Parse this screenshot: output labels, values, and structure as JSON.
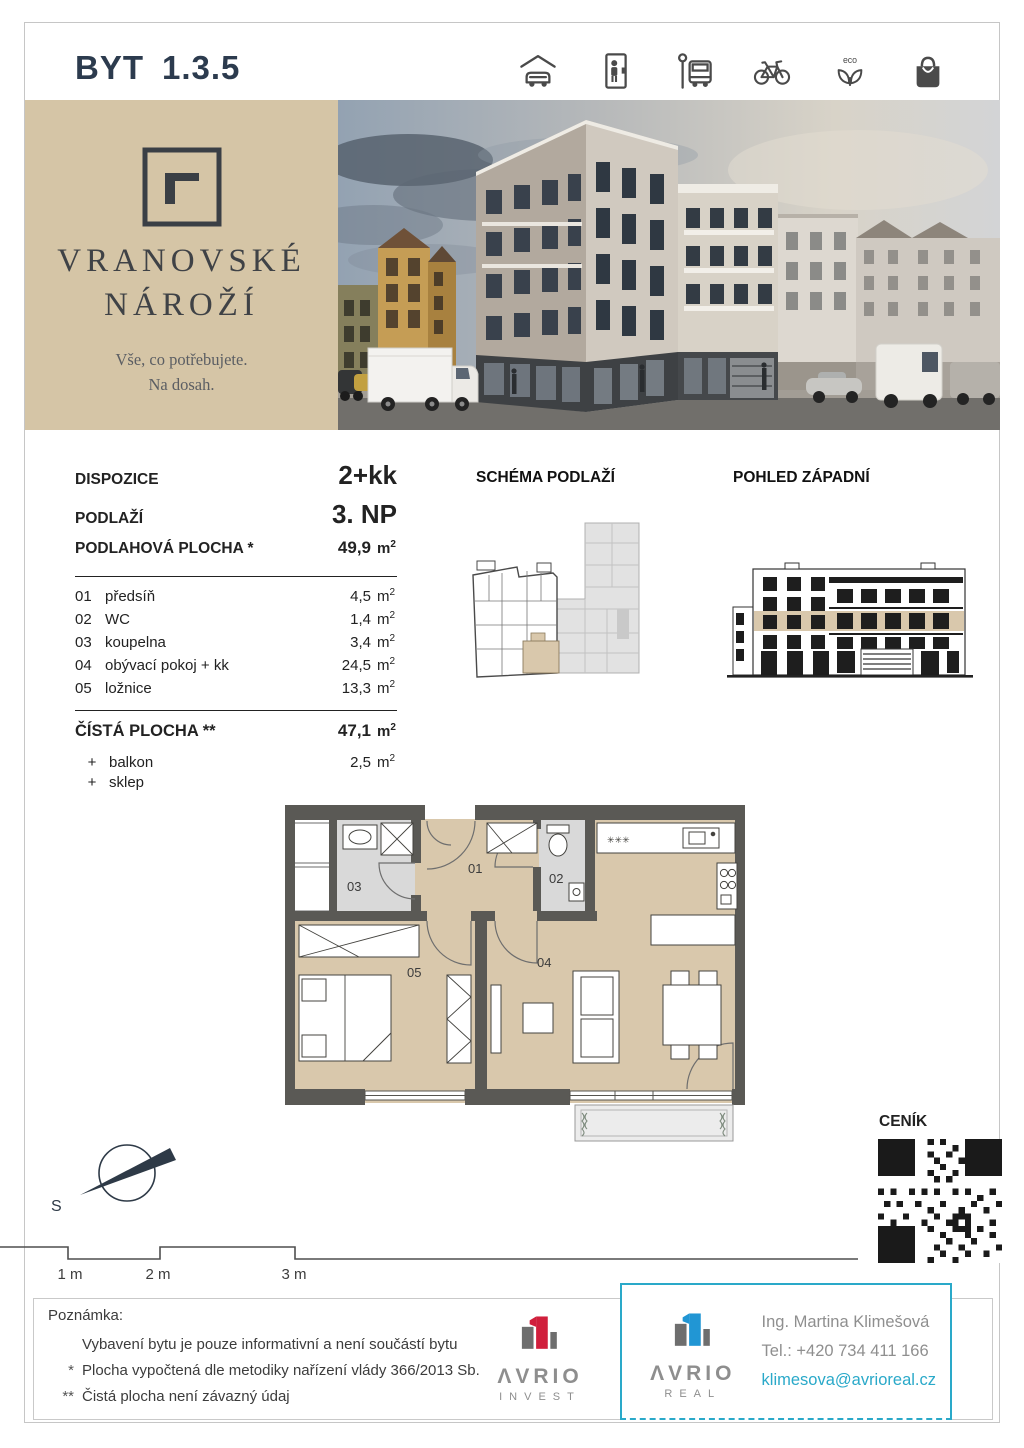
{
  "header": {
    "title_prefix": "BYT",
    "title_number": "1.3.5"
  },
  "amenities": {
    "eco_label": "eco"
  },
  "brand": {
    "line1": "VRANOVSKÉ",
    "line2": "NÁROŽÍ",
    "tagline1": "Vše, co potřebujete.",
    "tagline2": "Na dosah."
  },
  "specs": {
    "rows_main": [
      {
        "label": "DISPOZICE",
        "value": "2+kk"
      },
      {
        "label": "PODLAŽÍ",
        "value": "3. NP"
      }
    ],
    "area_label": "PODLAHOVÁ PLOCHA *",
    "area_value": "49,9",
    "unit_m": "m",
    "unit_sup": "2",
    "rooms": [
      {
        "num": "01",
        "name": "předsíň",
        "area": "4,5"
      },
      {
        "num": "02",
        "name": "WC",
        "area": "1,4"
      },
      {
        "num": "03",
        "name": "koupelna",
        "area": "3,4"
      },
      {
        "num": "04",
        "name": "obývací pokoj + kk",
        "area": "24,5"
      },
      {
        "num": "05",
        "name": "ložnice",
        "area": "13,3"
      }
    ],
    "net_label": "ČÍSTÁ PLOCHA **",
    "net_value": "47,1",
    "extras": [
      {
        "sign": "+",
        "name": "balkon",
        "area": "2,5"
      },
      {
        "sign": "+",
        "name": "sklep",
        "area": ""
      }
    ]
  },
  "sections": {
    "schema": "SCHÉMA PODLAŽÍ",
    "elevation": "POHLED ZÁPADNÍ",
    "price": "CENÍK"
  },
  "floorplan": {
    "r1": "01",
    "r2": "02",
    "r3": "03",
    "r4": "04",
    "r5": "05"
  },
  "compass": {
    "south": "S"
  },
  "scalebar": {
    "l1": "1 m",
    "l2": "2 m",
    "l3": "3 m"
  },
  "notes": {
    "heading": "Poznámka:",
    "line1": "Vybavení bytu je pouze informativní a není součástí bytu",
    "marker2": "*",
    "line2": "Plocha vypočtená dle metodiky nařízení vlády 366/2013 Sb.",
    "marker3": "**",
    "line3": "Čistá plocha není závazný údaj"
  },
  "footer": {
    "invest": {
      "brand": "ΛVRIO",
      "sub": "INVEST"
    },
    "real": {
      "brand": "ΛVRIO",
      "sub": "REAL"
    },
    "contact": {
      "name": "Ing. Martina Klimešová",
      "phone": "Tel.: +420 734 411 166",
      "email": "klimesova@avrioreal.cz"
    }
  },
  "colors": {
    "accent_navy": "#2c3b4e",
    "brand_beige": "#d5c5a6",
    "plan_beige": "#d9c8ac",
    "teal": "#2aa9c9",
    "invest_red": "#d01f3c",
    "real_blue": "#2196d4"
  }
}
